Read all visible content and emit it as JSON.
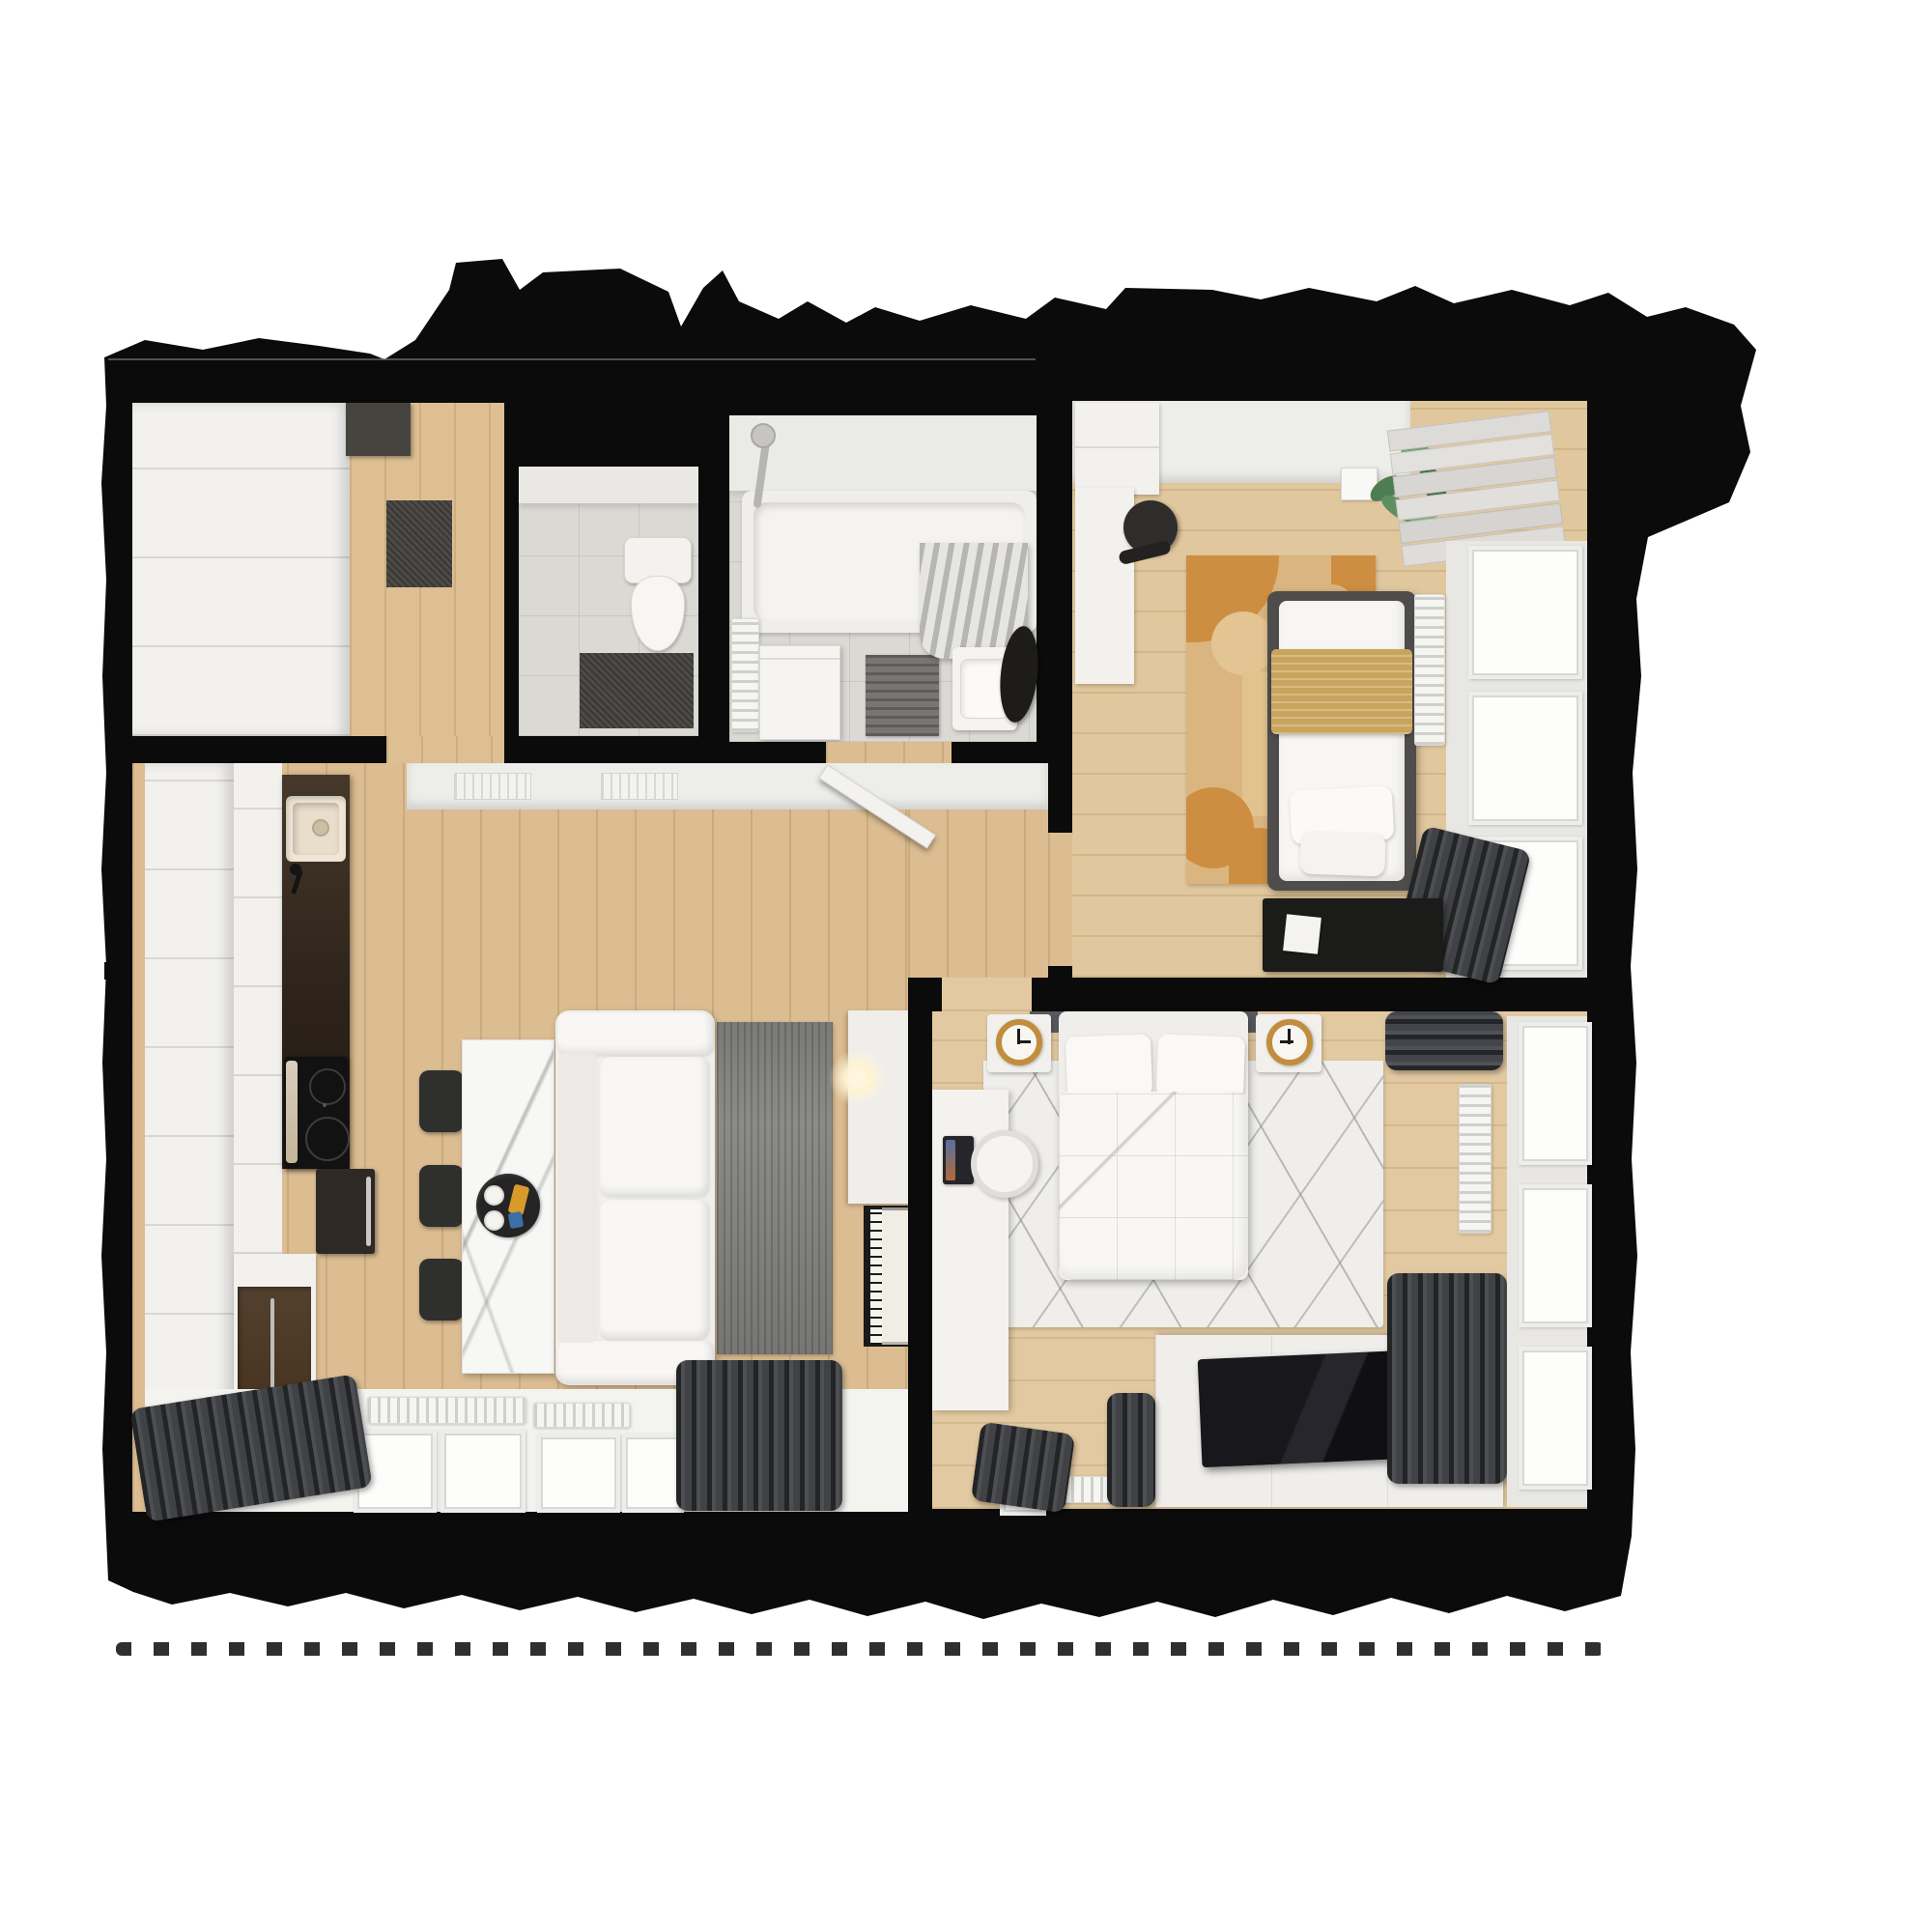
{
  "meta": {
    "title": "Apartment 3D floor plan — top-down render",
    "view": "top-down",
    "style": "photoreal 3D cutaway on white background"
  },
  "palette": {
    "background": "#ffffff",
    "walls": "#0b0b0b",
    "wood_floor": "#dcbd92",
    "light_wood_floor": "#e2c89f",
    "tile_floor": "#dbd9d4",
    "cabinet_white": "#f2f1ee",
    "counter_dark_wood": "#3a2e23",
    "accent_mustard": "#c9a45c",
    "rug_orange": "#cd8e41",
    "rug_tan": "#dab57f",
    "rug_gray": "#8b8b89",
    "rug_white": "#efeeea",
    "curtain_dark": "#404245",
    "clock_gold": "#c28d3c"
  },
  "rooms": {
    "entry": {
      "label": "Entry hall",
      "furniture": [
        "sliding-door wardrobe",
        "storage locker",
        "dark doormat",
        "wood floor"
      ]
    },
    "toilet": {
      "label": "WC",
      "furniture": [
        "toilet",
        "dark bath mat",
        "tile floor"
      ]
    },
    "bathroom": {
      "label": "Bathroom",
      "furniture": [
        "bathtub",
        "shower fixture",
        "shower curtain",
        "washing machine",
        "towel radiator",
        "sink vanity",
        "black vessel basin",
        "striped bath mat"
      ]
    },
    "bedroom1": {
      "label": "Single bedroom",
      "furniture": [
        "single bed with mustard throw",
        "wardrobe",
        "desk",
        "black office chair",
        "geometric orange rug",
        "potted plant",
        "ceiling light",
        "roman blind",
        "radiator",
        "black low dresser",
        "gray curtains",
        "windows"
      ]
    },
    "living": {
      "label": "Living room with kitchen",
      "furniture": [
        "kitchen cabinets",
        "dark countertop",
        "kitchen sink",
        "induction cooktop",
        "oven",
        "tall cabinet with wood door",
        "marble dining table",
        "black tray with cups",
        "three black chairs",
        "white sofa",
        "gray runner rug",
        "media console",
        "table lamp",
        "upright piano",
        "radiators",
        "windows",
        "dark curtains",
        "open bathroom door"
      ]
    },
    "bedroom2": {
      "label": "Master bedroom",
      "furniture": [
        "double bed with white duvet",
        "two pillows",
        "gray headboard",
        "two nightstands",
        "gold wall clocks",
        "white line-pattern rug",
        "desk with laptop",
        "white desk chair",
        "TV dresser",
        "flat TV",
        "radiators",
        "windows",
        "dark curtains"
      ]
    }
  }
}
